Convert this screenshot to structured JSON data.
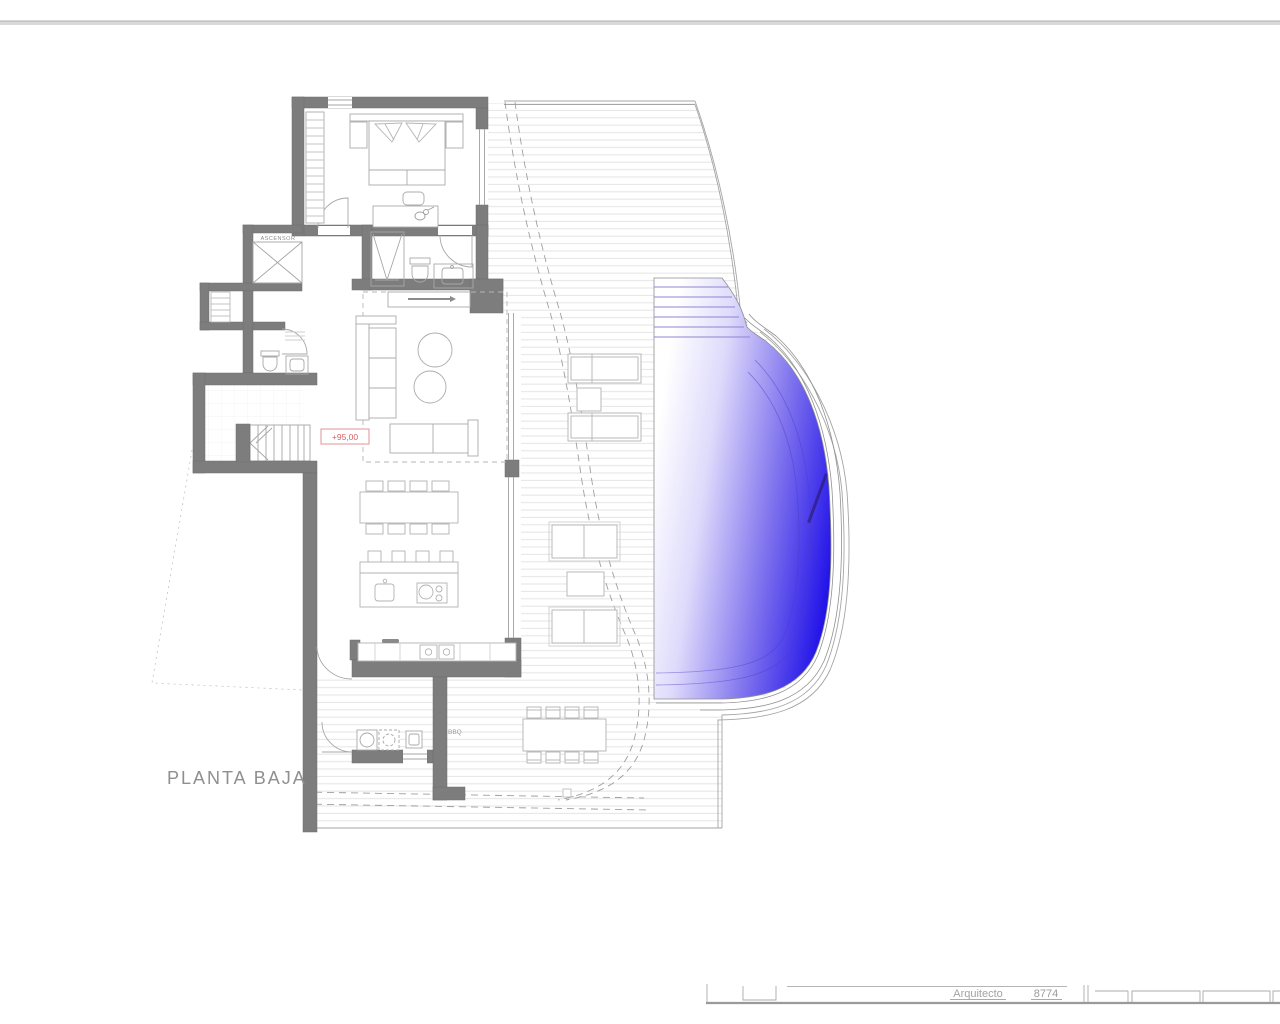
{
  "plan": {
    "title": "PLANTA BAJA",
    "level_marker": "+95,00",
    "labels": {
      "elevator": "ASCENSOR",
      "bbq": "BBQ"
    },
    "rooms": [
      "bedroom",
      "bathroom",
      "elevator",
      "hall",
      "stairs",
      "guest-wc",
      "living-room",
      "dining-area",
      "kitchen",
      "utility-room",
      "bbq-terrace",
      "deck",
      "pool"
    ]
  },
  "title_block": {
    "architect_label": "Arquitecto",
    "architect_number": "8774"
  },
  "colors": {
    "wall_fill": "#7d7d7d",
    "wall_edge": "#6e6e6e",
    "outline_gray": "#9a9a9a",
    "furniture_gray": "#a9a9a9",
    "deck_line": "#e4e4e4",
    "pool_light": "#ffffff",
    "pool_mid": "#8478ee",
    "pool_deep": "#1e0fe8",
    "level_red": "#d96161",
    "label_gray": "#8f8f8f"
  }
}
